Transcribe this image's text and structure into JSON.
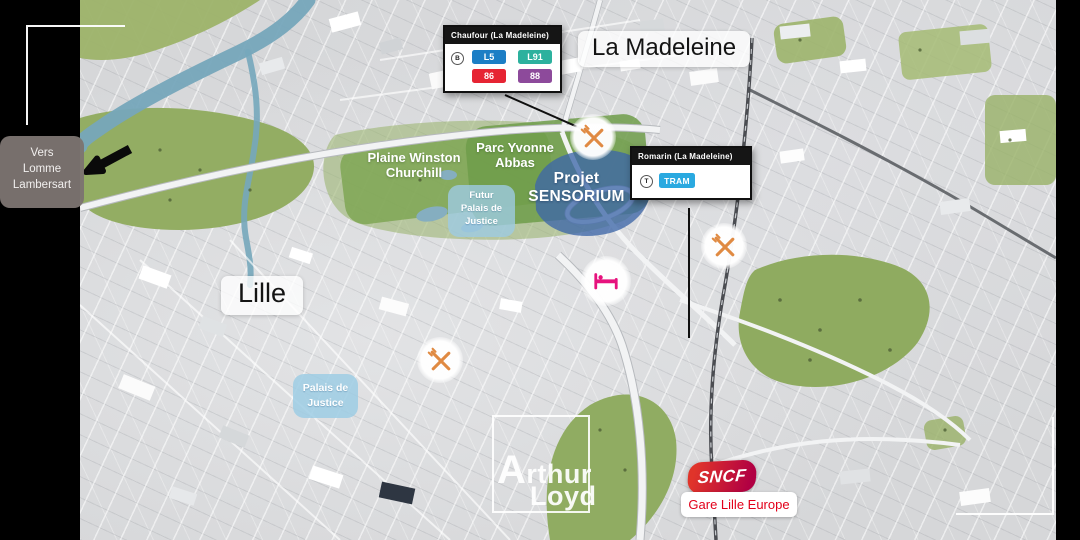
{
  "city_labels": {
    "la_madeleine": "La Madeleine",
    "lille": "Lille"
  },
  "direction_sign": {
    "lines": [
      "Vers",
      "Lomme",
      "Lambersart"
    ],
    "icon": "arrow-left"
  },
  "parks": {
    "plaine_winston": {
      "lines": [
        "Plaine Winston",
        "Churchill"
      ]
    },
    "parc_abbas": {
      "lines": [
        "Parc Yvonne",
        "Abbas"
      ]
    }
  },
  "project": {
    "lines": [
      "Projet",
      "SENSORIUM"
    ],
    "color": "#3e66a8"
  },
  "justice": {
    "futur": {
      "lines": [
        "Futur",
        "Palais de",
        "Justice"
      ]
    },
    "palais": {
      "lines": [
        "Palais de",
        "Justice"
      ]
    },
    "color": "#9ecae2"
  },
  "transit_callouts": {
    "chaufour": {
      "title": "Chaufour (La Madeleine)",
      "mode_letter": "B",
      "mode_icon": "bus-circle-icon",
      "badges": [
        {
          "label": "L5",
          "color": "#1c7ec5"
        },
        {
          "label": "L91",
          "color": "#2cb19e"
        },
        {
          "label": "86",
          "color": "#e62433"
        },
        {
          "label": "88",
          "color": "#8d4a9b"
        }
      ]
    },
    "romarin": {
      "title": "Romarin (La Madeleine)",
      "mode_letter": "T",
      "mode_icon": "tram-circle-icon",
      "badges": [
        {
          "label": "TRAM",
          "color": "#2aa9e0"
        }
      ]
    }
  },
  "markers": {
    "restaurant": {
      "icon": "crossed-fork-knife",
      "count": 3,
      "color": "#e08a42"
    },
    "hotel": {
      "icon": "bed",
      "color": "#e6127d"
    }
  },
  "station": {
    "brand": "SNCF",
    "name": "Gare Lille Europe",
    "brand_color": "#c1113a",
    "name_color": "#e2001a"
  },
  "watermark": {
    "line1": "Arthur",
    "line2": "Loyd"
  },
  "palette": {
    "park_green": "#8fab60",
    "water_blue": "#76a7bb",
    "letterbox": "#000000"
  }
}
